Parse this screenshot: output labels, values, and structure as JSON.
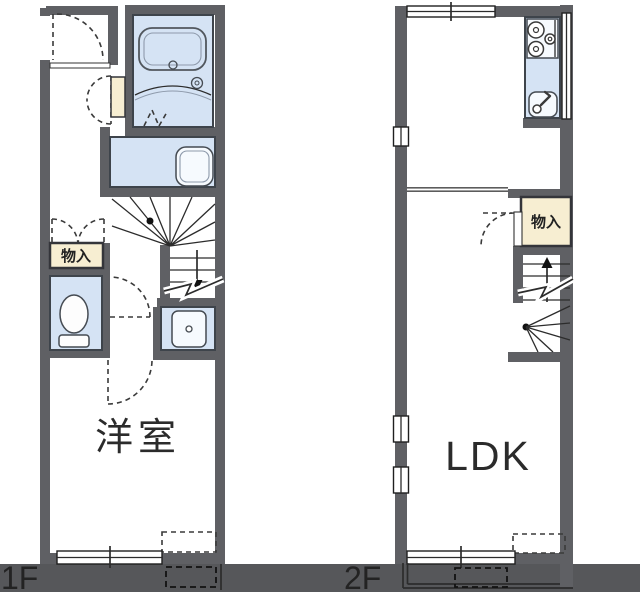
{
  "colors": {
    "bg": "#ffffff",
    "wall": "#5f6064",
    "bar": "#56575a",
    "wet": "#d5e3f4",
    "cream": "#f7eed2"
  },
  "floor_plan": {
    "floors": [
      {
        "bar_label": "1F",
        "room_label": "洋室",
        "storage_label": "物入",
        "features": [
          "entrance-door",
          "unit-bath",
          "bathtub",
          "washroom-laundry-unit",
          "storage-double-door",
          "toilet",
          "washbasin",
          "stairs-down",
          "sliding-window",
          "dashed-outline-box"
        ]
      },
      {
        "bar_label": "2F",
        "room_label": "LDK",
        "storage_label": "物入",
        "features": [
          "kitchen-stove",
          "kitchen-sink",
          "storage-door",
          "stairs-up",
          "sliding-window",
          "side-windows",
          "balcony",
          "dashed-outline-box"
        ]
      }
    ]
  }
}
